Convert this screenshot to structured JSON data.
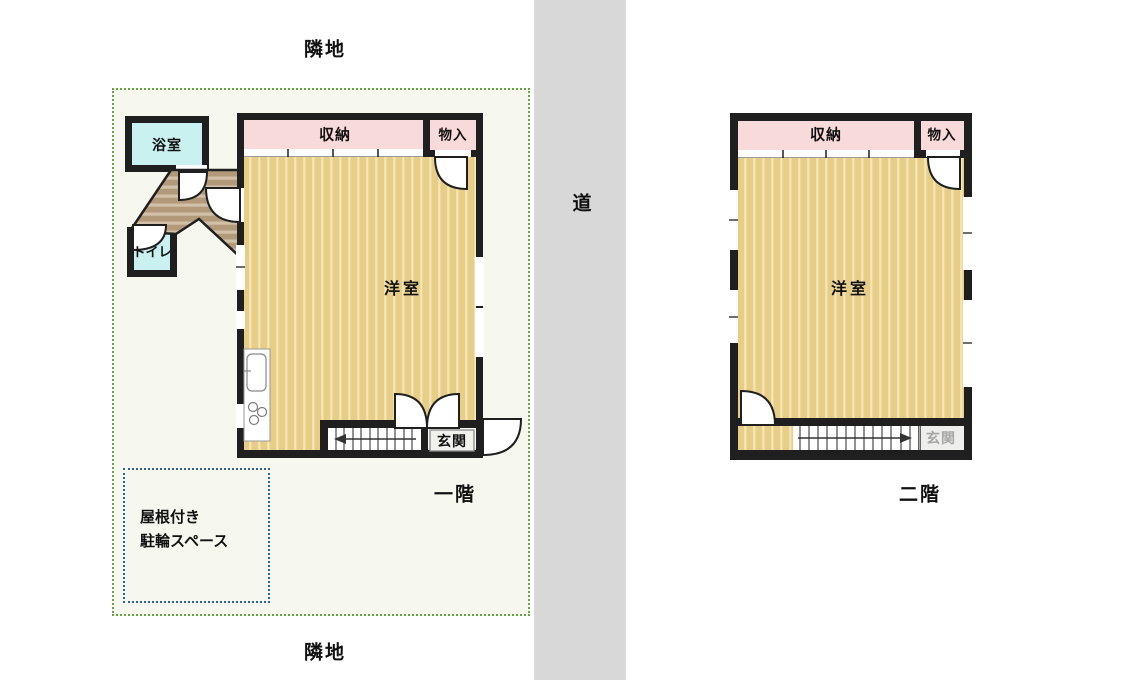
{
  "site": {
    "adjacent_top": "隣地",
    "adjacent_bottom": "隣地",
    "road_label": "道"
  },
  "first_floor": {
    "caption": "一階",
    "rooms": {
      "bath": "浴室",
      "toilet": "トイレ",
      "storage": "収納",
      "closet": "物入",
      "western_room": "洋室",
      "entrance": "玄関"
    }
  },
  "second_floor": {
    "caption": "二階",
    "rooms": {
      "storage": "収納",
      "closet": "物入",
      "western_room": "洋室",
      "entrance": "玄関"
    }
  },
  "bike_space": {
    "line1": "屋根付き",
    "line2": "駐輪スペース"
  },
  "colors": {
    "wall": "#1f1f1f",
    "floor_tan": "#e7cd85",
    "floor_tan_stripe": "#f3e7ba",
    "storage_pink": "#f9dadb",
    "wet_room_cyan": "#c9f1ef",
    "hall_brown": "#b2997a",
    "hall_brown_stripe": "#d2c0a8",
    "road_gray": "#d8d8d8",
    "site_bg": "#f6f8f0",
    "site_border_green": "#6aa24a",
    "bike_border_blue": "#2c5fa8"
  }
}
